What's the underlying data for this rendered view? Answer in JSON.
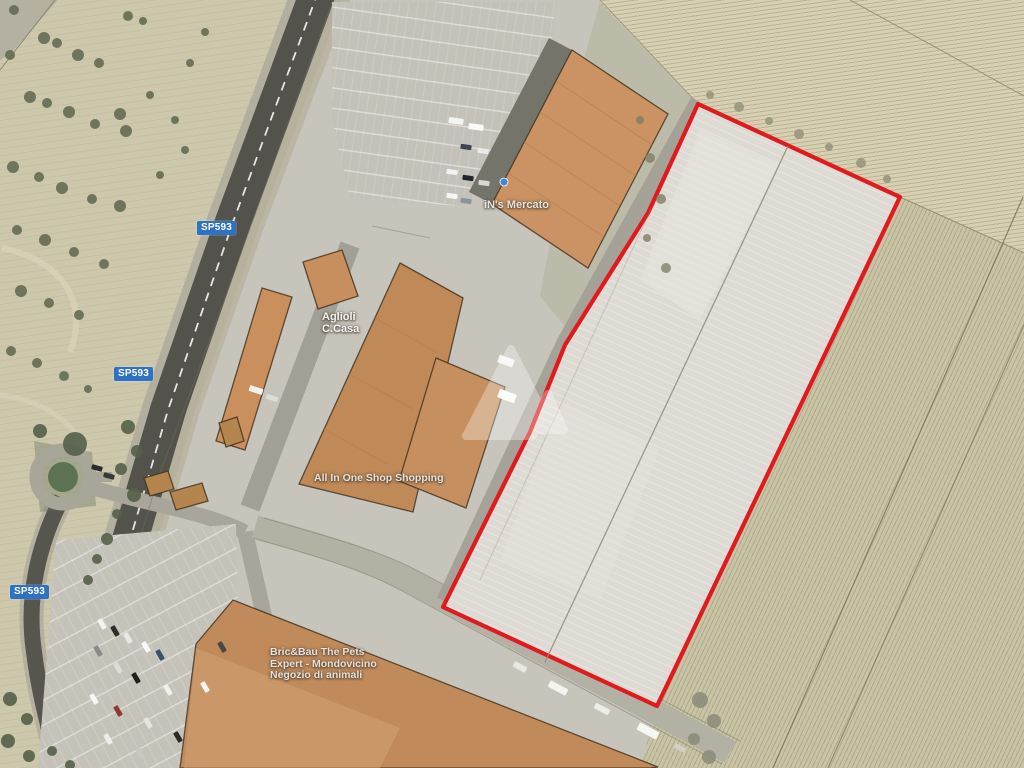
{
  "map": {
    "road_label": "SP593",
    "labels": {
      "supermarket": "iN's Mercato",
      "shop_line1": "Aglioli",
      "shop_line2": "C.Casa",
      "mall": "All In One Shop Shopping",
      "pet_line1": "Bric&Bau The Pets",
      "pet_line2": "Expert - Mondovicino",
      "pet_line3": "Negozio di animali"
    },
    "parcel": {
      "outline_color": "#e11a1f"
    },
    "colors": {
      "badge_blue": "#2e72c6",
      "roof_orange": "#c8915f",
      "asphalt": "#53534c",
      "field_olive": "#c9c4a6",
      "parcel_fill": "#dcdad2"
    },
    "icons": {
      "watermark": "site-logo-watermark-icon",
      "store_marker": "store-location-dot-icon"
    }
  }
}
